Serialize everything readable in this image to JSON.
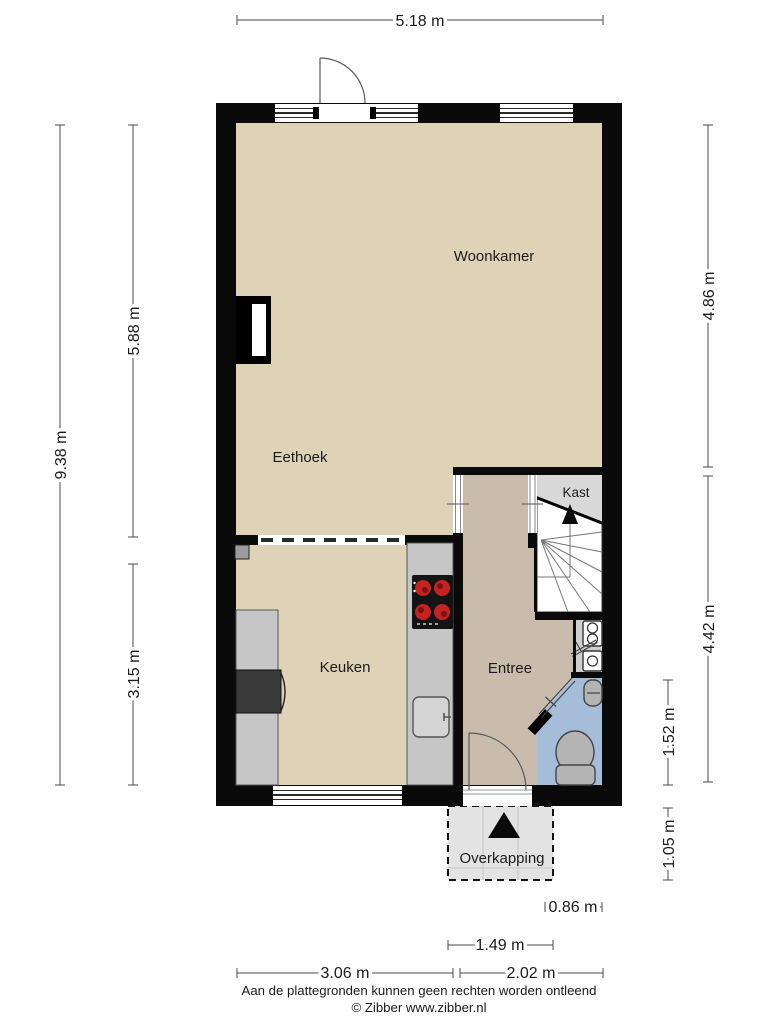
{
  "rooms": {
    "woonkamer": "Woonkamer",
    "eethoek": "Eethoek",
    "keuken": "Keuken",
    "entree": "Entree",
    "kast": "Kast",
    "overkapping": "Overkapping"
  },
  "dims": {
    "top": "5.18 m",
    "left_total": "9.38 m",
    "left_upper": "5.88 m",
    "left_lower": "3.15 m",
    "right_upper": "4.86 m",
    "right_lower": "4.42 m",
    "toilet": "1.52 m",
    "canopy_height": "1.05 m",
    "canopy_offset": "0.86 m",
    "canopy_width": "1.49 m",
    "bottom_left": "3.06 m",
    "bottom_right": "2.02 m"
  },
  "footer": {
    "disclaimer": "Aan de plattegronden kunnen geen rechten worden ontleend",
    "copyright": "© Zibber www.zibber.nl"
  },
  "icons": {
    "stairs_up_arrow": "triangle-up",
    "entrance_arrow": "triangle-up"
  },
  "colors": {
    "wall": "#0a0a0a",
    "floor": "#ded3b6",
    "entree": "#c9bcad",
    "toilet": "#a6bdd9",
    "kast": "#d8d8d8",
    "stairs": "#ffffff",
    "meterkast": "#cfcfcf",
    "counter": "#c6c6c6",
    "appliance": "#3a3a3a",
    "stove_burner": "#c52222",
    "fixture": "#b4b4b4",
    "overkapping": "#e3e3e3"
  }
}
